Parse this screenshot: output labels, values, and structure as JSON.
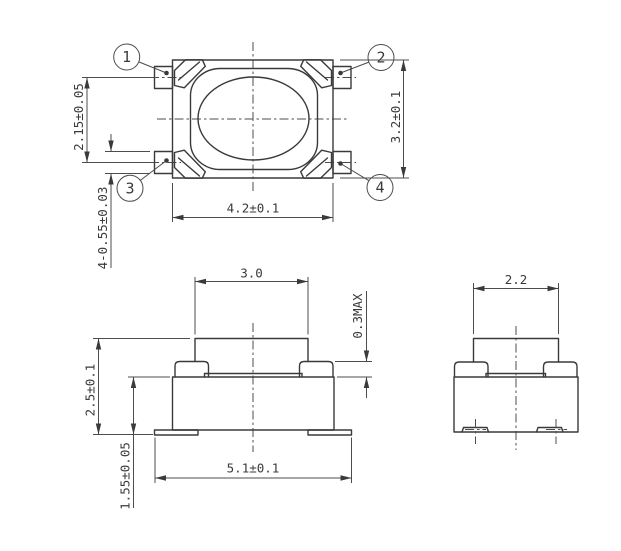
{
  "views": {
    "top": {
      "pin_labels": [
        "1",
        "2",
        "3",
        "4"
      ],
      "dims": {
        "pitch": "2.15±0.05",
        "pin_width": "4-0.55±0.03",
        "width": "4.2±0.1",
        "height": "3.2±0.1"
      }
    },
    "front": {
      "dims": {
        "button_width": "3.0",
        "bump_protrusion": "0.3MAX",
        "height_total": "2.5±0.1",
        "height_body": "1.55±0.05",
        "lead_span": "5.1±0.1"
      }
    },
    "side": {
      "dims": {
        "button_depth": "2.2"
      }
    }
  },
  "colors": {
    "line": "#3a3a3a",
    "background": "#ffffff"
  }
}
